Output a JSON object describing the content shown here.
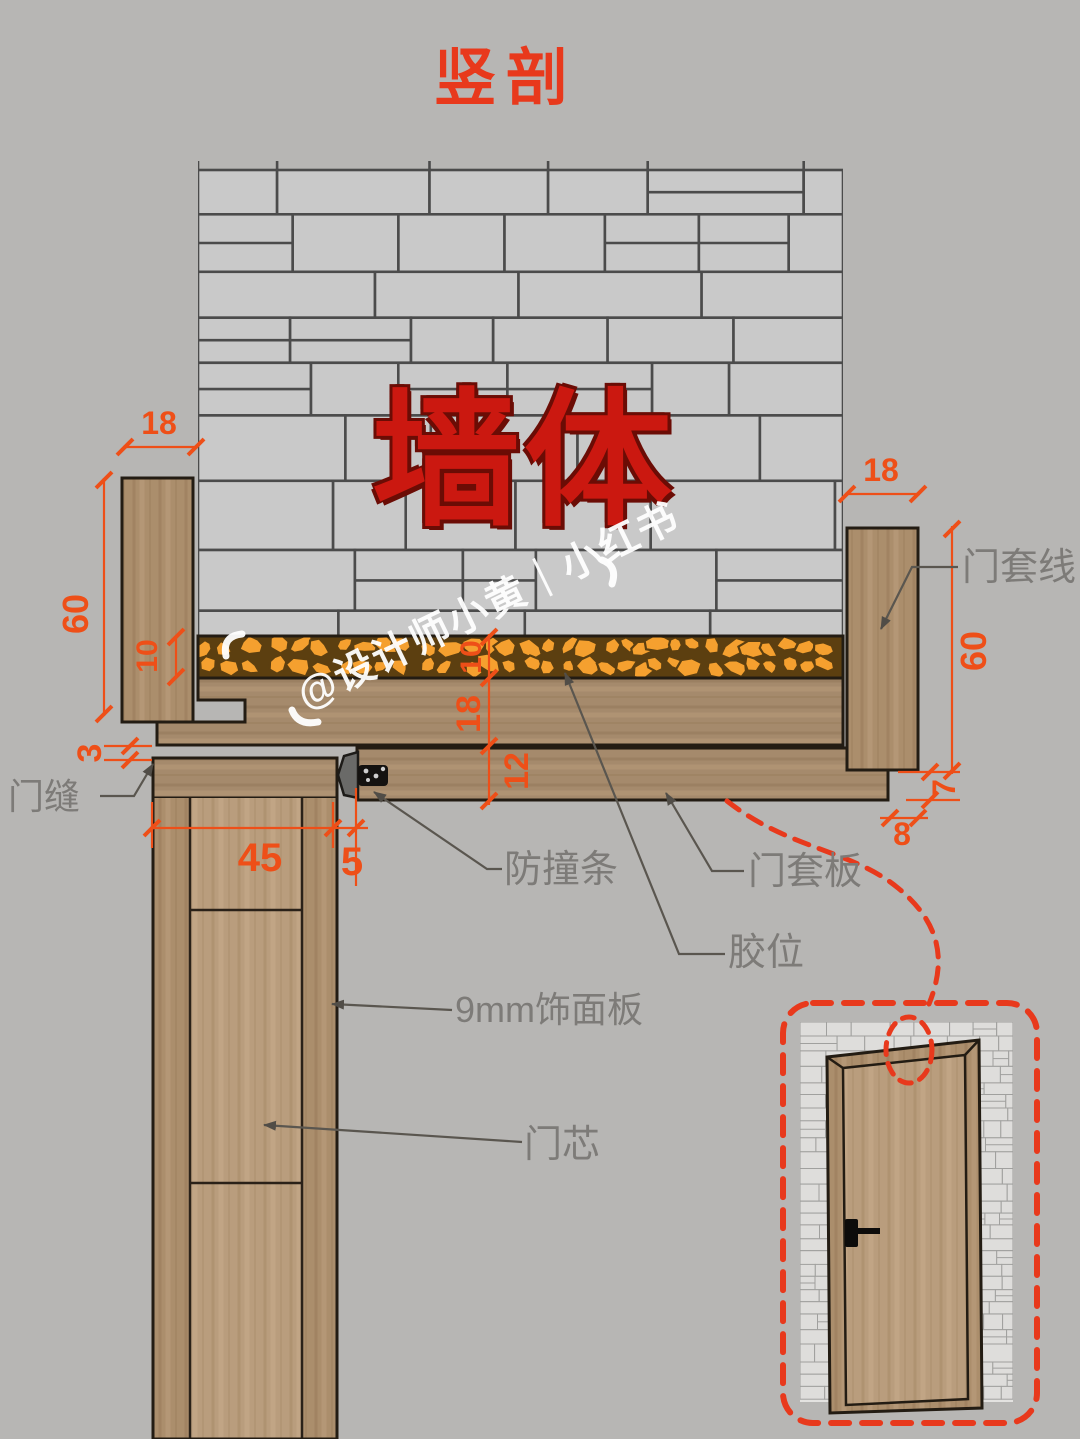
{
  "title": "竖剖",
  "wall_label": "墙体",
  "watermark": "@设计师小黄｜小红书",
  "labels": {
    "door_gap": "门缝",
    "bumper": "防撞条",
    "casing_board": "门套板",
    "glue": "胶位",
    "veneer": "9mm饰面板",
    "door_core": "门芯",
    "casing_line": "门套线"
  },
  "dims": {
    "left_18": "18",
    "left_60": "60",
    "left_10": "10",
    "left_3": "3",
    "door_45": "45",
    "seal_5": "5",
    "mid_10": "10",
    "mid_18": "18",
    "mid_12": "12",
    "right_18": "18",
    "right_60": "60",
    "right_7": "7",
    "right_8": "8"
  },
  "colors": {
    "background": "#b7b6b4",
    "dimension_orange": "#ee4f18",
    "accent_red_dashed": "#e8391c",
    "wall_text_red": "#cb1810",
    "label_grey": "#7d7b78",
    "brick_fill": "#c9c9c9",
    "brick_joint": "#4b4b4b",
    "wood": "#ab8e6c",
    "wood_light": "#b99d7d",
    "glue_orange": "#f5a02f",
    "glue_dark": "#5c3f10",
    "outline": "#231c13",
    "watermark_white": "#ffffff"
  }
}
